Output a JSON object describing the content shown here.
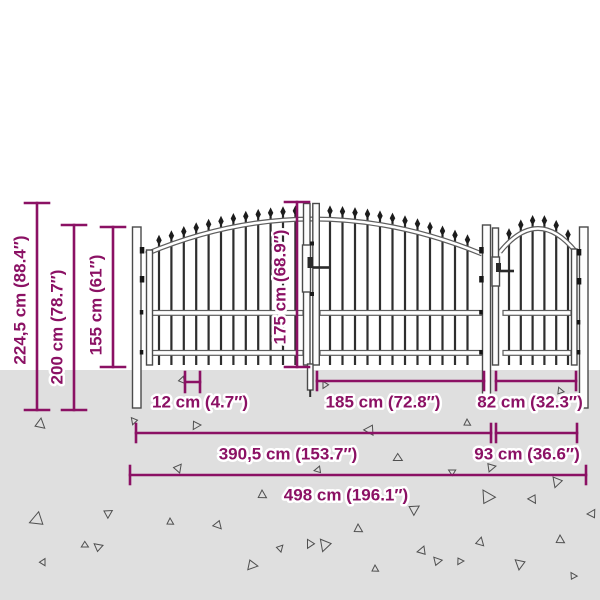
{
  "diagram": {
    "title": "Garden gate with spear top - dimension diagram",
    "colors": {
      "annotation": "#8B1164",
      "ground": "#DFDFDF",
      "metal_dark": "#2E2E2E",
      "background": "#FFFFFF"
    },
    "labels": {
      "total_height": "224,5 cm (88.4″)",
      "post_height": "200 cm (78.7″)",
      "side_height": "155 cm (61″)",
      "gate_height": "175 cm (68.9″)",
      "bar_spacing": "12 cm (4.7″)",
      "double_leaf_width": "185 cm (72.8″)",
      "single_gate_width": "82 cm (32.3″)",
      "double_gate_total_width": "390,5 cm (153.7″)",
      "single_section_width": "93 cm (36.6″)",
      "total_width": "498 cm (196.1″)"
    }
  }
}
